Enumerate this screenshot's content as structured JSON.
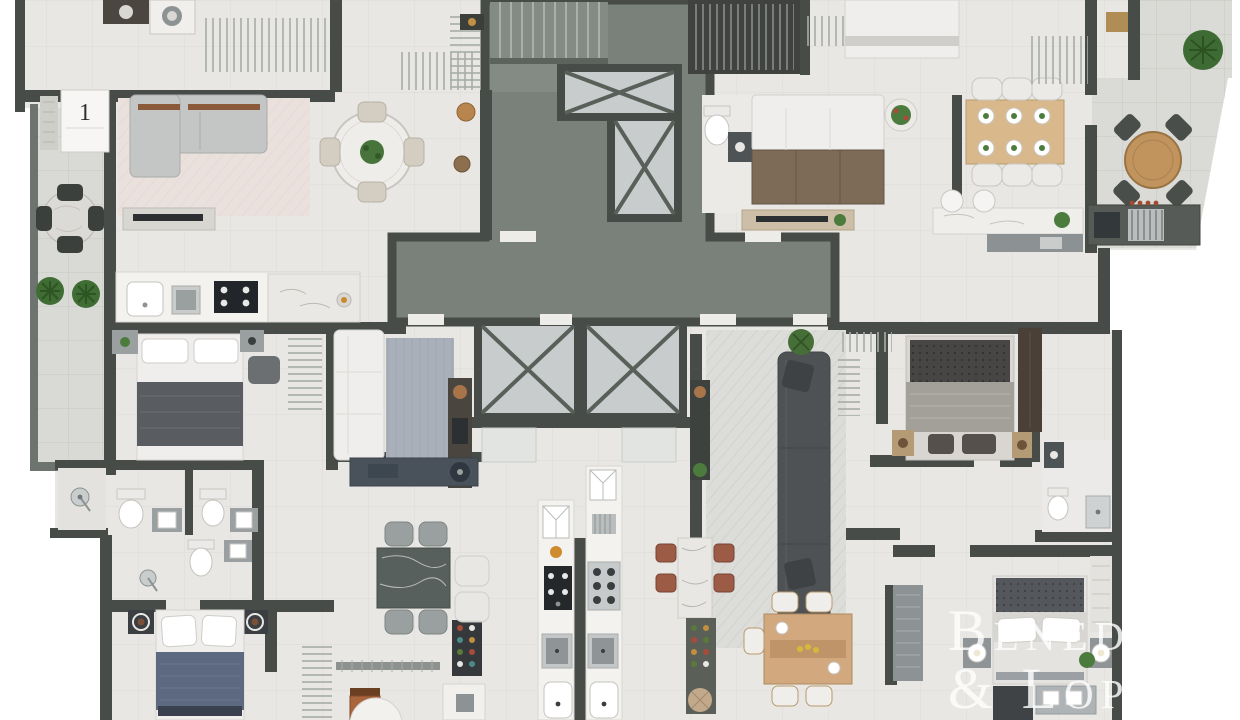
{
  "scene": {
    "kind": "architectural floor plan, top-down 3D render of a residential storey with four apartments around a central core"
  },
  "watermark": {
    "line1": "Beneduzi",
    "line2": "& Lopes",
    "color": "#ffffff"
  },
  "door_label": {
    "text": "1"
  },
  "palette": {
    "background": "#ffffff",
    "wall": "#474c48",
    "wall_light": "#6d736e",
    "floor": "#e8e7e3",
    "balcony_floor": "#d9d9d5",
    "corridor": "#7a817b",
    "elevator_cab": "#c9cccd",
    "elevator_x": "#596059",
    "wood": "#c59a6a",
    "sofa_dark": "#4f5254",
    "sofa_brown": "#7d6b57",
    "bed_blue": "#5c6980",
    "rug_pink": "#eae0dc",
    "rug_blue": "#a9b0ba",
    "plant_green": "#47743a",
    "stool_red": "#9c5b45",
    "counter_dark": "#24282b",
    "marble": "#f3f2ef"
  },
  "icons": [
    "stairs-icon",
    "elevator-x-icon",
    "bed-icon",
    "sofa-icon",
    "dining-table-icon",
    "chair-icon",
    "plant-icon",
    "toilet-icon",
    "sink-icon",
    "shower-icon",
    "cooktop-icon",
    "stove-icon",
    "refrigerator-icon",
    "washer-icon",
    "grill-icon",
    "wardrobe-rack-icon",
    "nightstand-icon",
    "rug-icon",
    "bar-stool-icon",
    "wine-rack-icon",
    "tv-console-icon",
    "laundry-tub-icon"
  ]
}
